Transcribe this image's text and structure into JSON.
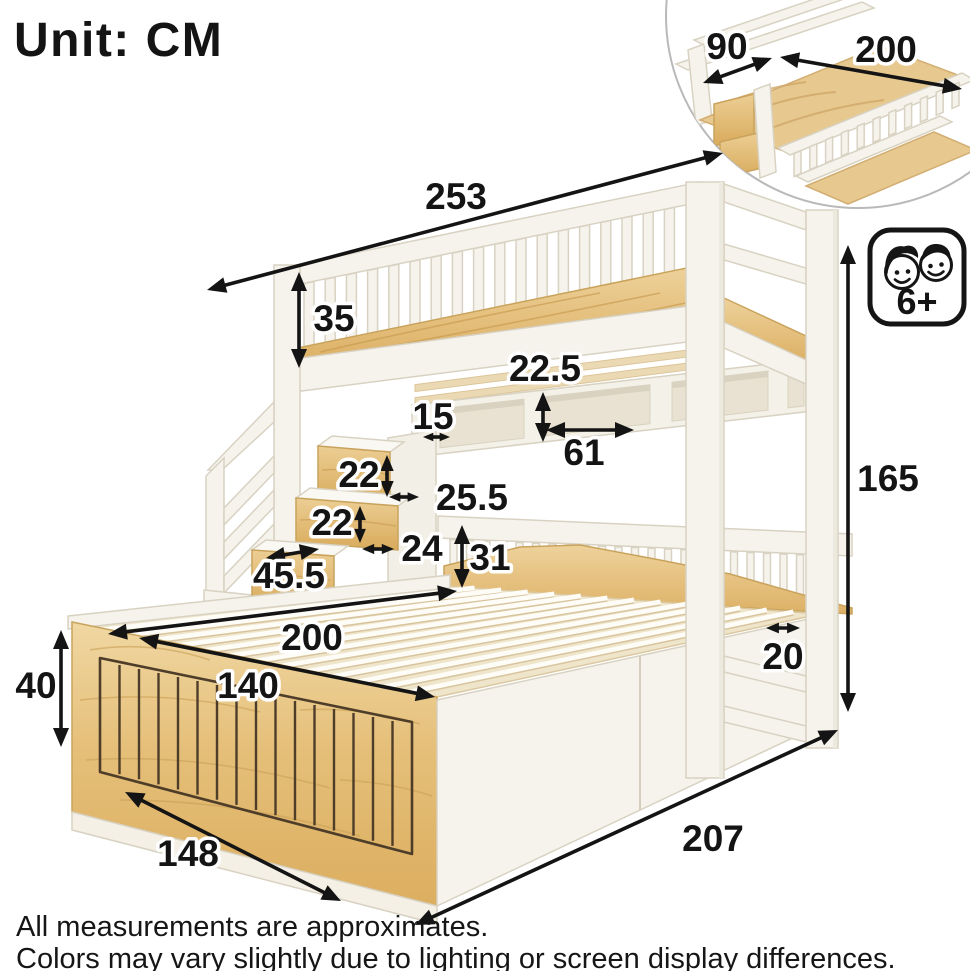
{
  "unit_label": "Unit: CM",
  "age_badge": {
    "label": "6+"
  },
  "inset": {
    "width_cm": "90",
    "length_cm": "200"
  },
  "dimensions": {
    "upper_bed_length": "253",
    "guardrail_height": "35",
    "shelf_height": "22.5",
    "shelf_side_gap": "15",
    "shelf_width": "61",
    "upper_step_rise": "22",
    "upper_step_depth": "25.5",
    "lower_step_rise": "22",
    "lower_step_depth": "24",
    "step_width": "45.5",
    "footboard_height": "31",
    "lower_bed_length": "200",
    "headboard_panel_width": "140",
    "headboard_height": "40",
    "post_width": "20",
    "overall_height": "165",
    "lower_bed_front_width": "148",
    "overall_depth": "207"
  },
  "footnotes": [
    "All measurements are approximates.",
    "Colors may vary slightly due to lighting or screen display differences."
  ]
}
